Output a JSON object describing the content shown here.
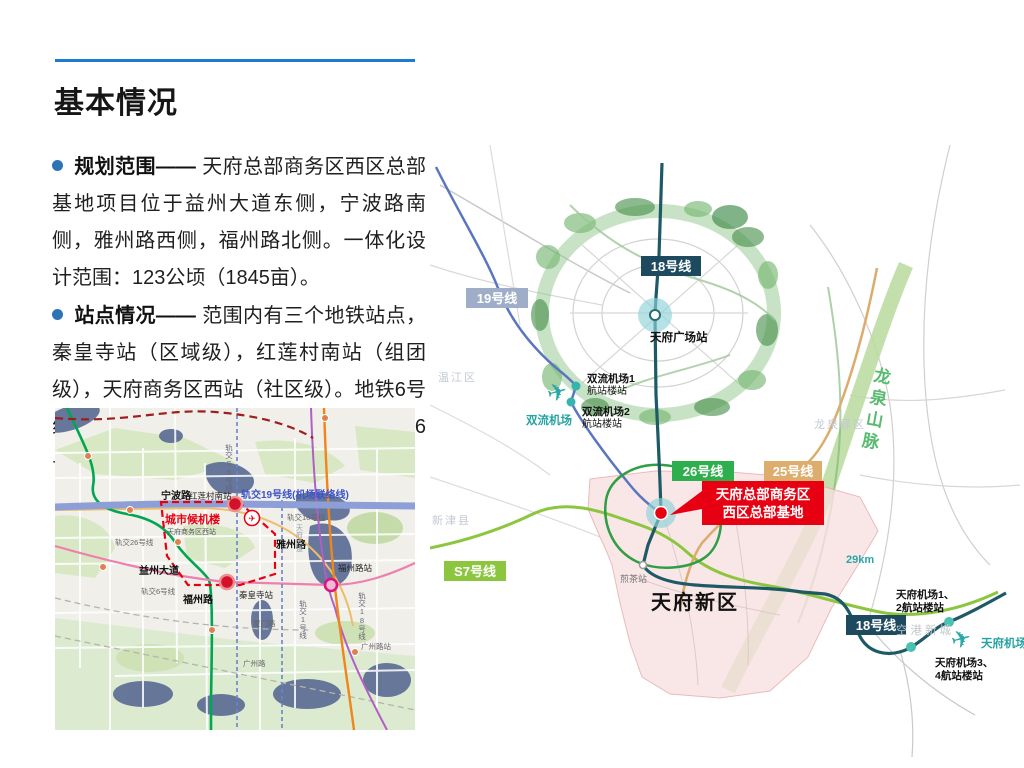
{
  "slide": {
    "title": "基本情况",
    "accent_color": "#1f7ad1",
    "bullet_color": "#2e74b5",
    "highlight_red": "#e60012"
  },
  "icons": {
    "plane": "✈"
  },
  "bullets": [
    {
      "head": "规划范围——",
      "body": "天府总部商务区西区总部基地项目位于益州大道东侧，宁波路南侧，雅州路西侧，福州路北侧。一体化设计范围：123公顷（1845亩）。"
    },
    {
      "head": "站点情况——",
      "body": "范围内有三个地铁站点，秦皇寺站（区域级），红莲村南站（组团级），天府商务区西站（社区级）。地铁6号线(已运营), 19号线（在建），16号、26号、S5号线（远期规划）。"
    }
  ],
  "small_map": {
    "labels": {
      "rail19": "轨交19号线(机场联络线)",
      "rail16": "轨交16号线",
      "rail26": "轨交26号线",
      "rail6": "轨交6号线",
      "rail1": "轨交1号线",
      "rail18": "轨交18号线",
      "railS5": "轨交S5号线",
      "ningbo_road": "宁波路",
      "honglian_station": "红莲村南站",
      "city_terminal": "城市候机楼",
      "tianfu_west_station": "天府商务区西站",
      "yazhou_road": "雅州路",
      "yizhou_avenue": "益州大道",
      "fuzhou_road": "福州路",
      "qinhuangsi_station": "秦皇寺站",
      "fuzhou_station": "福州路站",
      "xiamen_road": "厦门路",
      "guangzhou_road": "广州路",
      "guangzhou_station": "广州路站",
      "tianfu_avenue": "天府大道"
    }
  },
  "big_map": {
    "lines": {
      "line18": {
        "label": "18号线",
        "color": "#1d5a66",
        "badge_color": "#1d4a5f"
      },
      "line19": {
        "label": "19号线",
        "color": "#5b76c0",
        "badge_color": "#9fadc9"
      },
      "line26": {
        "label": "26号线",
        "color": "#2f9e44",
        "badge_color": "#2fae4d"
      },
      "line25": {
        "label": "25号线",
        "color": "#dcab6e",
        "badge_color": "#ddad6e"
      },
      "lineS7": {
        "label": "S7号线",
        "color": "#8cc63f",
        "badge_color": "#8cc63f"
      }
    },
    "labels": {
      "tianfu_square_station": "天府广场站",
      "shuangliu_airport": "双流机场",
      "shuangliu_t1_line1": "双流机场1",
      "shuangliu_t1_line2": "航站楼站",
      "shuangliu_t2_line1": "双流机场2",
      "shuangliu_t2_line2": "航站楼站",
      "project_line1": "天府总部商务区",
      "project_line2": "西区总部基地",
      "longquan_mountains": "龙泉山脉",
      "tianfu_new_area": "天府新区",
      "jiancha_station": "煎茶站",
      "tianfu_airport": "天府机场",
      "tianfu_t12_line1": "天府机场1、",
      "tianfu_t12_line2": "2航站楼站",
      "tianfu_t34_line1": "天府机场3、",
      "tianfu_t34_line2": "4航站楼站",
      "konggang_new_city": "空港新城",
      "distance": "29km",
      "wenjiang": "温江区",
      "xinjin": "新津县",
      "longquanyi": "龙泉驿区"
    }
  }
}
